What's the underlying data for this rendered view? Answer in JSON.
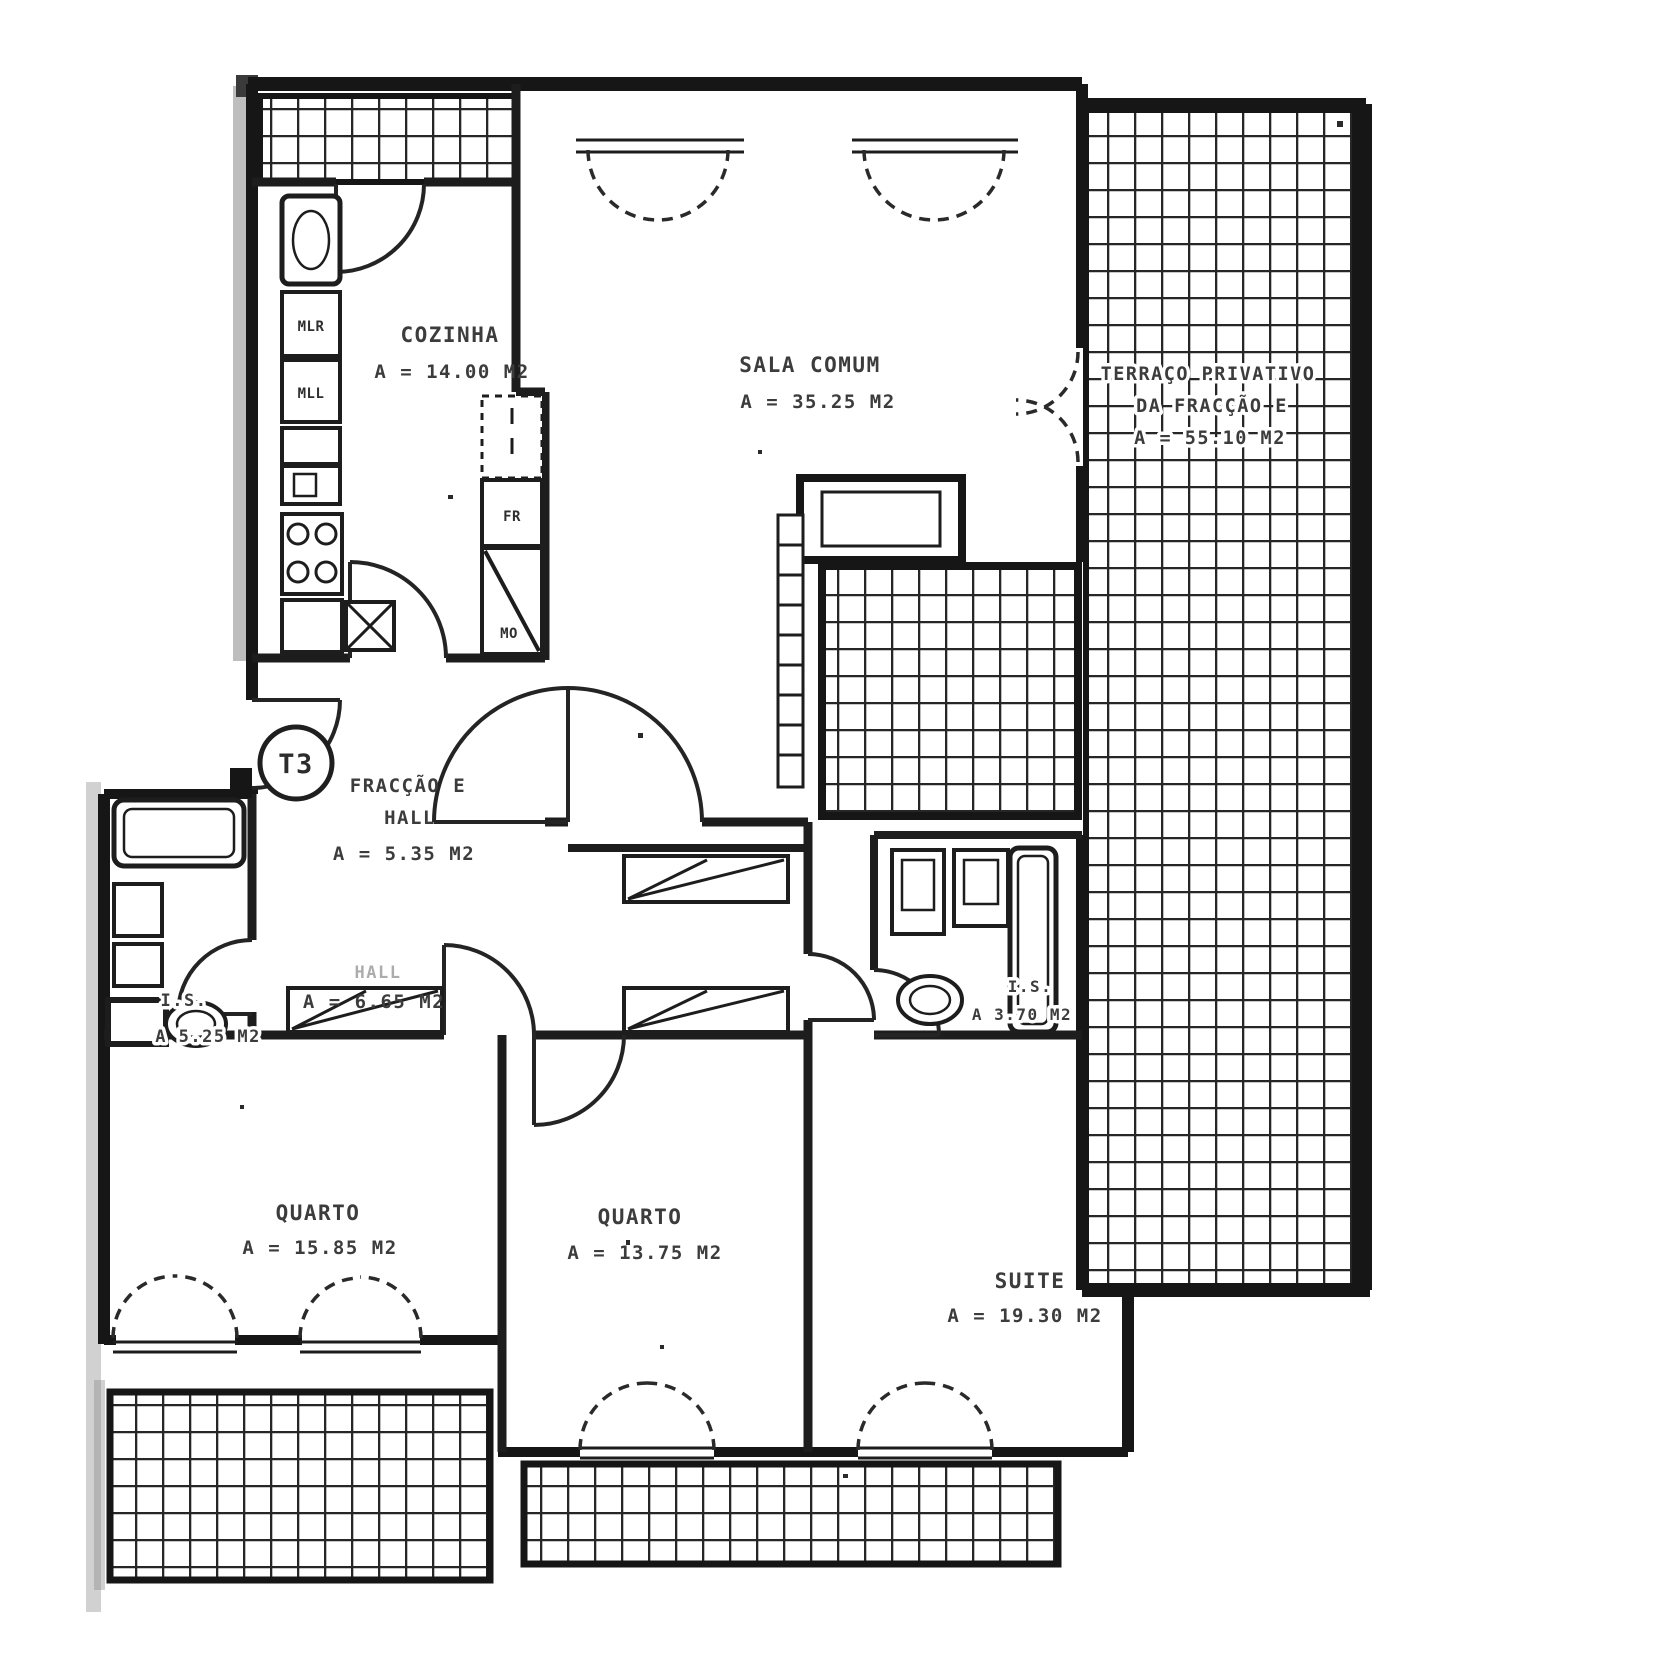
{
  "badge": {
    "label": "T3"
  },
  "rooms": {
    "cozinha": {
      "name": "COZINHA",
      "area": "A = 14.00 M2"
    },
    "sala": {
      "name": "SALA COMUM",
      "area": "A = 35.25 M2"
    },
    "terraco": {
      "line1": "TERRAÇO PRIVATIVO",
      "line2": "DA FRACÇÃO E",
      "area": "A = 55.10 M2"
    },
    "hall_entrada": {
      "line1": "FRACÇÃO E",
      "line2": "HALL",
      "area": "A = 5.35 M2"
    },
    "hall_interior": {
      "name": "HALL",
      "area": "A = 6.65 M2"
    },
    "is_esquerda": {
      "name": "I.S.",
      "area": "A  5.25 M2"
    },
    "is_suite": {
      "name": "I.S.",
      "area": "A  3.70 M2"
    },
    "quarto_1": {
      "name": "QUARTO",
      "area": "A = 15.85 M2"
    },
    "quarto_2": {
      "name": "QUARTO",
      "area": "A = 13.75 M2"
    },
    "suite": {
      "name": "SUITE",
      "area": "A = 19.30 M2"
    }
  },
  "appliances": {
    "mlr": "MLR",
    "mll": "MLL",
    "fr": "FR",
    "mo": "MO"
  }
}
